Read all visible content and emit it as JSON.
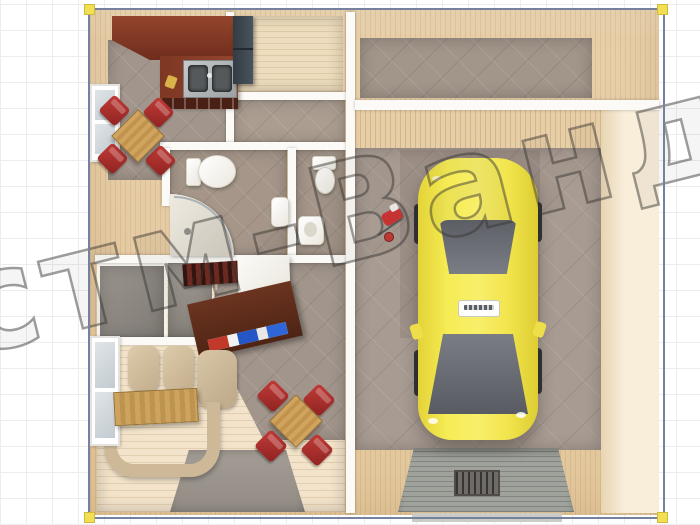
{
  "watermark": {
    "text": "стм-Ванда",
    "style": "outline",
    "stroke_color": "rgba(55,52,48,0.48)"
  },
  "selection": {
    "border_color": "#76819f",
    "handle_color": "#f2df52",
    "handles": [
      "top-left",
      "top-right",
      "bottom-left",
      "bottom-right"
    ]
  },
  "canvas": {
    "background": "#ffffff",
    "grid_color": "#ededed"
  },
  "plan": {
    "type": "3d-top-view-floor-plan-render",
    "wall_color": "#f3e6d0",
    "rooms": [
      {
        "name": "kitchen",
        "floor_color": "#a2968c"
      },
      {
        "name": "pantry",
        "floor_color": "#e8d8bd"
      },
      {
        "name": "hallway",
        "floor_color": "#ab9d90"
      },
      {
        "name": "bathroom-1",
        "floor_color": "#a59689"
      },
      {
        "name": "bathroom-2",
        "floor_color": "#a59689"
      },
      {
        "name": "entrance",
        "floor_color": "#8f8a84"
      },
      {
        "name": "living-room",
        "floor_color": "#f2e3ca"
      },
      {
        "name": "utility-room",
        "floor_color": "#a2958a"
      },
      {
        "name": "garage",
        "floor_color": "#a89b92"
      }
    ],
    "furniture": [
      "kitchen-counter",
      "kitchen-sink",
      "refrigerator-wardrobe",
      "kitchen-dining-table",
      "kitchen-chairs-red",
      "toilet",
      "corner-shower",
      "washbasin",
      "toilet-2",
      "washbasin-2",
      "bookshelf",
      "white-cabinet",
      "desk-tv-stand",
      "sofa-set",
      "coffee-table",
      "living-dining-table",
      "living-chairs-red",
      "rug-runner",
      "garage-ramp",
      "drain-grate",
      "red-bike"
    ],
    "car": {
      "name": "yellow-car",
      "body_color": "#f2e44c",
      "glass_color": "#6f747a",
      "license_plate": ""
    },
    "accent_colors": {
      "counter": "#7e3b28",
      "chairs": "#b23131",
      "car": "#f2e44c",
      "walls": "#f3e6d0",
      "tile": "#a89b92"
    }
  }
}
